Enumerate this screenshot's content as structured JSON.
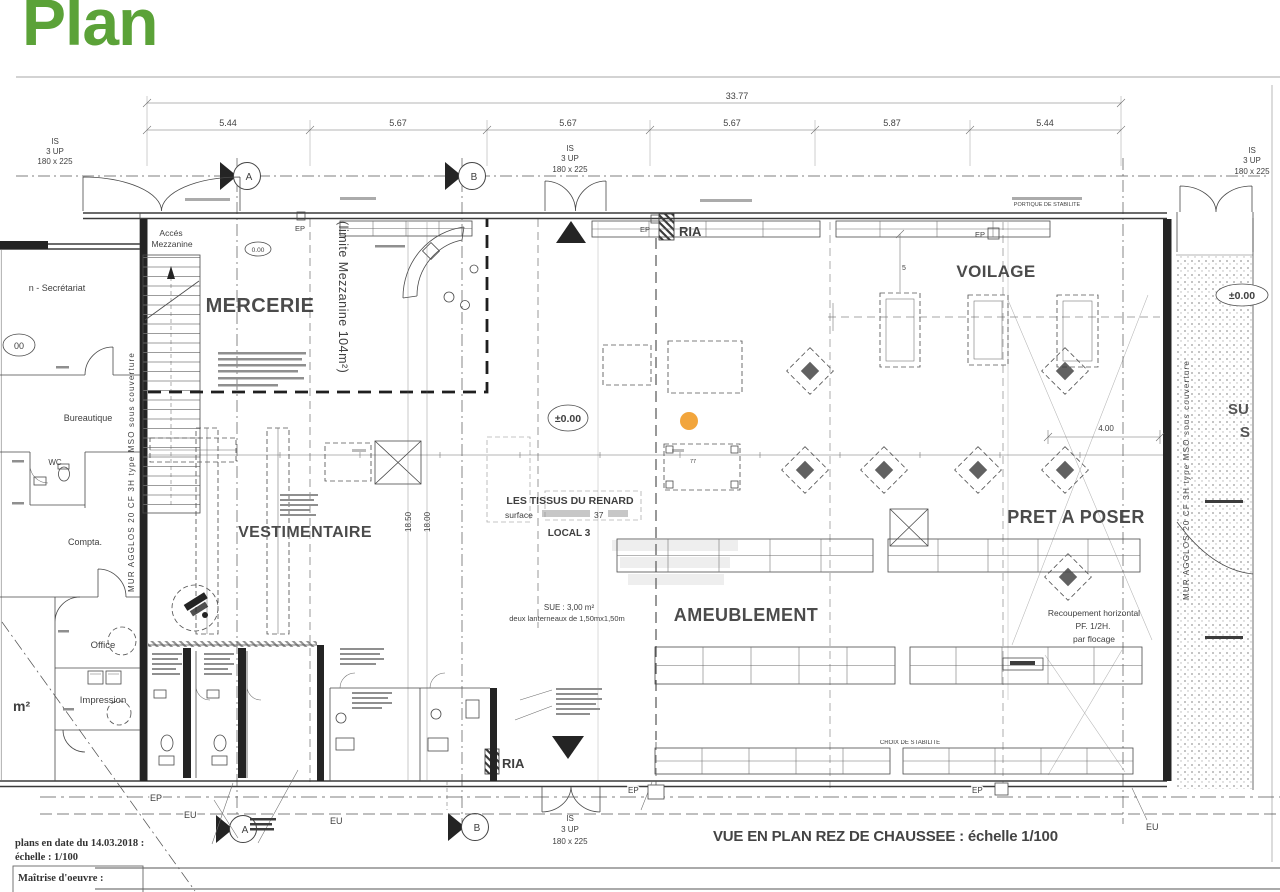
{
  "slide": {
    "title": "Plan"
  },
  "colors": {
    "title_green": "#5ba238",
    "marker_orange": "#F2A53C"
  },
  "plan": {
    "scale_caption": "VUE EN PLAN REZ DE CHAUSSEE : échelle 1/100",
    "departments": {
      "mercerie": "MERCERIE",
      "voilage": "VOILAGE",
      "vestimentaire": "VESTIMENTAIRE",
      "ameublement": "AMEUBLEMENT",
      "pret_a_poser": "PRET A POSER"
    },
    "tenant": {
      "name": "LES TISSUS DU RENARD",
      "surface_word": "surface",
      "surface_value": "37",
      "local": "LOCAL 3",
      "sue": "SUE : 3,00 m²",
      "lanterneaux": "deux lanterneaux de 1,50mx1,50m"
    },
    "rooms": {
      "acces1": "Accés",
      "acces2": "Mezzanine",
      "secretariat": "n - Secrétariat",
      "bureautique": "Bureautique",
      "wc": "WC",
      "compta": "Compta.",
      "office": "Office",
      "impression": "Impression",
      "m2": "m²"
    },
    "walls": {
      "mur": "MUR AGGLOS 20 CF 3H type MSO sous couverture",
      "limite": "(limite Mezzanine 104m²)",
      "portique": "PORTIQUE DE STABILITE",
      "croix": "CROIX DE STABILITE"
    },
    "fire": {
      "ria": "RIA"
    },
    "nets": {
      "ep": "EP",
      "eu": "EU"
    },
    "levels": {
      "zero": "±0.00",
      "zero_small": "0.00",
      "zero_left": "00"
    },
    "stairwell": {
      "l1": "IS",
      "l2": "3 UP",
      "l3": "180 x 225"
    },
    "grid": {
      "a": "A",
      "b": "B"
    },
    "dims": {
      "overall": "33.77",
      "segments": [
        "5.44",
        "5.67",
        "5.67",
        "5.67",
        "5.87",
        "5.44"
      ],
      "w4": "4.00",
      "v1": "18.50",
      "v2": "18.00",
      "five": "5",
      "n77": "77"
    },
    "notes": {
      "rec1": "Recoupement horizontal",
      "rec2": "PF. 1/2H.",
      "rec3": "par flocage",
      "su": "SU",
      "s": "S"
    },
    "footer": {
      "date": "plans en date du 14.03.2018 :",
      "scale": "échelle : 1/100",
      "moe": "Maîtrise d'oeuvre :"
    }
  }
}
